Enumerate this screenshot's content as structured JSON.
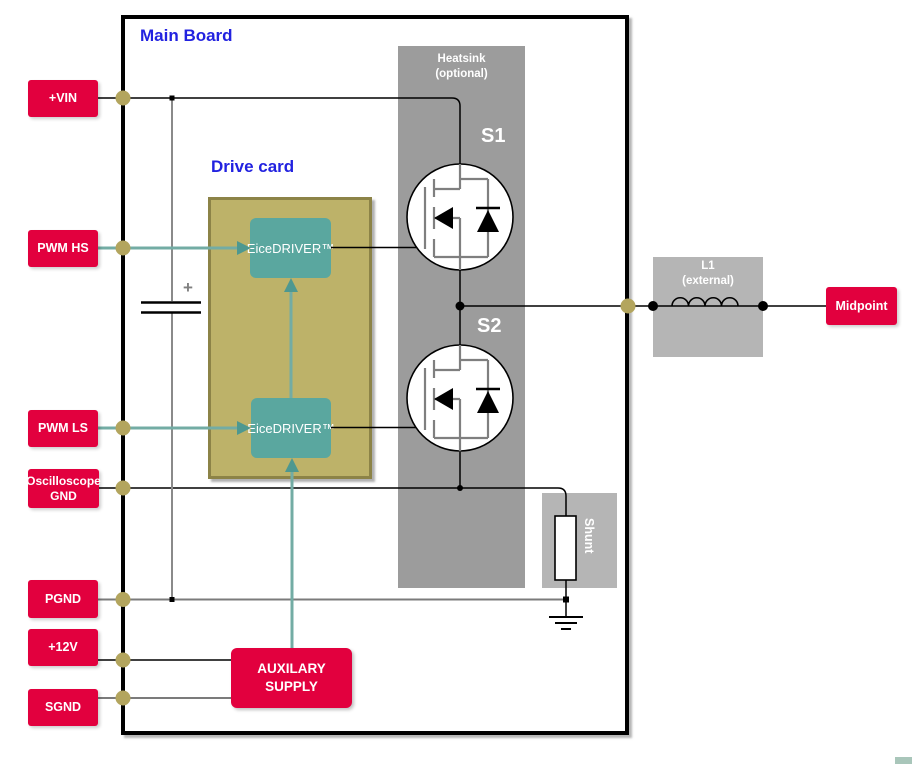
{
  "colors": {
    "red": "#E2003E",
    "blue": "#2222E0",
    "olive_fill": "#BDB269",
    "olive_border": "#8C8347",
    "teal_block": "#5AA79F",
    "teal_line": "#73ACA4",
    "teal_arrow": "#4E9890",
    "heatsink_gray": "#9C9C9C",
    "light_gray": "#B5B5B5",
    "dot_olive": "#B3A55E"
  },
  "board": {
    "title": "Main Board"
  },
  "drive_card": {
    "title": "Drive card",
    "driver_hs": "EiceDRIVER™",
    "driver_ls": "EiceDRIVER™"
  },
  "heatsink": {
    "line1": "Heatsink",
    "line2": "(optional)"
  },
  "switches": {
    "s1": "S1",
    "s2": "S2"
  },
  "inductor": {
    "line1": "L1",
    "line2": "(external)"
  },
  "shunt": {
    "label": "Shunt"
  },
  "aux_supply": {
    "line1": "AUXILARY",
    "line2": "SUPPLY"
  },
  "capacitor": {
    "polarity": "+"
  },
  "terminals": {
    "vin": "+VIN",
    "pwm_hs": "PWM HS",
    "pwm_ls": "PWM LS",
    "osc_gnd_line1": "Oscilloscope",
    "osc_gnd_line2": "GND",
    "pgnd": "PGND",
    "v12": "+12V",
    "sgnd": "SGND",
    "midpoint": "Midpoint"
  }
}
